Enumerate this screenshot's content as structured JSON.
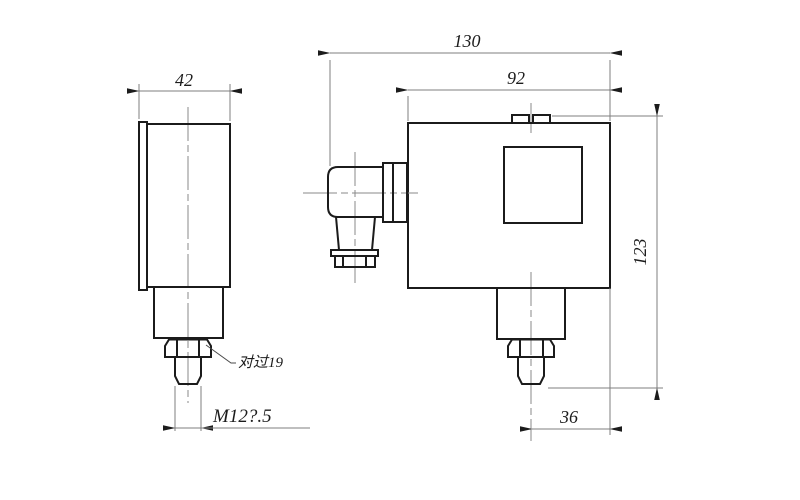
{
  "drawing": {
    "background": "#ffffff",
    "line_color": "#1b1b1b",
    "thin_line_color": "#7f7f7f",
    "side_view": {
      "width_dim": "42",
      "thread_spec": "M12?.5",
      "hex_flats_label": "对过19"
    },
    "front_view": {
      "overall_width_dim": "130",
      "body_width_dim": "92",
      "overall_height_dim": "123",
      "port_offset_dim": "36"
    }
  }
}
